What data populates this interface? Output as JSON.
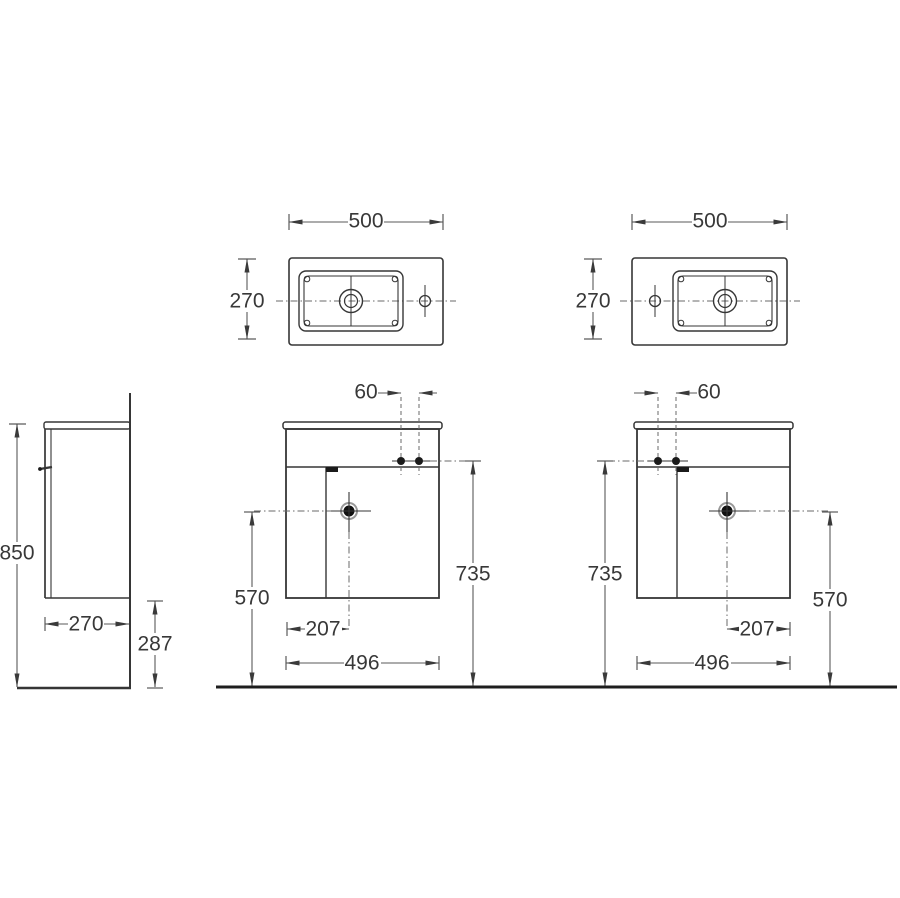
{
  "colors": {
    "background": "#ffffff",
    "object_line": "#363636",
    "dimension_line": "#5a5a5a",
    "text": "#383838",
    "dark_fill": "#1b1b1b"
  },
  "views": {
    "top_left": {
      "width": "500",
      "depth": "270"
    },
    "top_right": {
      "width": "500",
      "depth": "270"
    },
    "side": {
      "height": "850",
      "depth": "270",
      "clearance": "287"
    },
    "front_left": {
      "tap_spacing": "60",
      "rim_height": "735",
      "drain_height": "570",
      "drain_offset": "207",
      "width": "496"
    },
    "front_right": {
      "tap_spacing": "60",
      "rim_height": "735",
      "drain_height": "570",
      "drain_offset": "207",
      "width": "496"
    }
  }
}
